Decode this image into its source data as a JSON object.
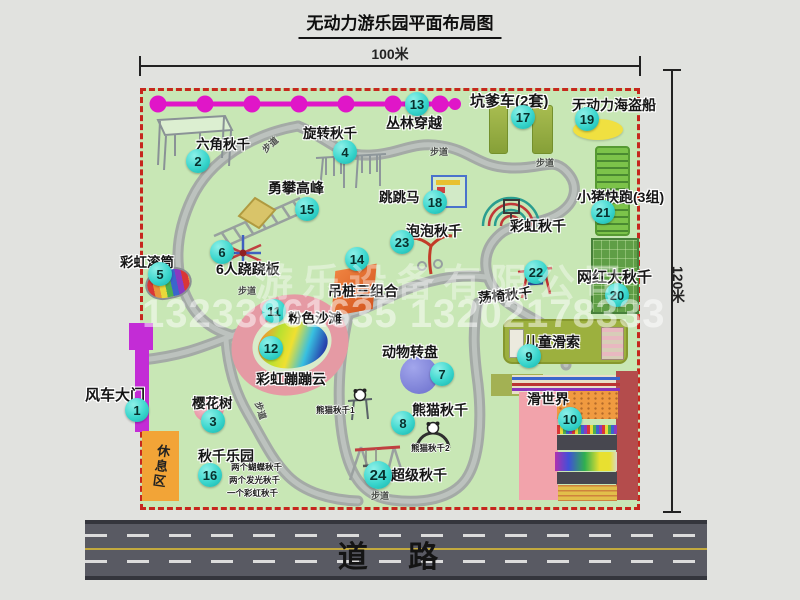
{
  "title": "无动力游乐园平面布局图",
  "dimensions": {
    "width_label": "100米",
    "height_label": "120米"
  },
  "road": {
    "label": "道 路"
  },
  "labels": {
    "trail": "步道",
    "rest_area": "休息区"
  },
  "watermark": {
    "company": "游乐设备有限公司",
    "phone": "13233861635 13202178333"
  },
  "attractions": {
    "gate": {
      "num": "1",
      "label": "风车大门"
    },
    "hex_swing": {
      "num": "2",
      "label": "六角秋千"
    },
    "cherry_tree": {
      "num": "3",
      "label": "樱花树"
    },
    "rotary_swing": {
      "num": "4",
      "label": "旋转秋千"
    },
    "rainbow_roller": {
      "num": "5",
      "label": "彩虹滚筒"
    },
    "seesaw": {
      "num": "6",
      "label": "6人跷跷板"
    },
    "animal_carousel": {
      "num": "7",
      "label": "动物转盘"
    },
    "panda_swing": {
      "num": "8",
      "label": "熊猫秋千",
      "sub1": "熊猫秋千1",
      "sub2": "熊猫秋千2"
    },
    "kids_zipline": {
      "num": "9",
      "label": "儿童滑索"
    },
    "slide_world": {
      "num": "10",
      "label": "滑世界"
    },
    "pink_beach": {
      "num": "11",
      "label": "粉色沙滩"
    },
    "bounce_cloud": {
      "num": "12",
      "label": "彩虹蹦蹦云"
    },
    "jungle_cross": {
      "num": "13",
      "label": "丛林穿越"
    },
    "hanging_piles": {
      "num": "14",
      "label": "吊桩三组合"
    },
    "climb_peak": {
      "num": "15",
      "label": "勇攀高峰"
    },
    "swing_park": {
      "num": "16",
      "label": "秋千乐园",
      "notes": [
        "两个蝴蝶秋千",
        "两个发光秋千",
        "一个彩虹秋千"
      ]
    },
    "pit_cart": {
      "num": "17",
      "label": "坑爹车(2套)"
    },
    "jump_horse": {
      "num": "18",
      "label": "跳跳马"
    },
    "pirate_ship": {
      "num": "19",
      "label": "无动力海盗船"
    },
    "big_swing": {
      "num": "20",
      "label": "网红大秋千"
    },
    "pig_run": {
      "num": "21",
      "label": "小猪快跑(3组)"
    },
    "chair_swing": {
      "num": "22",
      "label": "荡椅秋千"
    },
    "bubble_swing": {
      "num": "23",
      "label": "泡泡秋千"
    },
    "super_swing": {
      "num": "24",
      "label": "超级秋千"
    },
    "rainbow_swing": {
      "label": "彩虹秋千"
    }
  },
  "colors": {
    "map_green": "#c8e7b5",
    "border_red": "#c6271d",
    "badge_teal": "#3ad6cd",
    "zipline_magenta": "#e016c8",
    "gate_magenta": "#c32cd6",
    "rest_orange": "#f2a437"
  }
}
